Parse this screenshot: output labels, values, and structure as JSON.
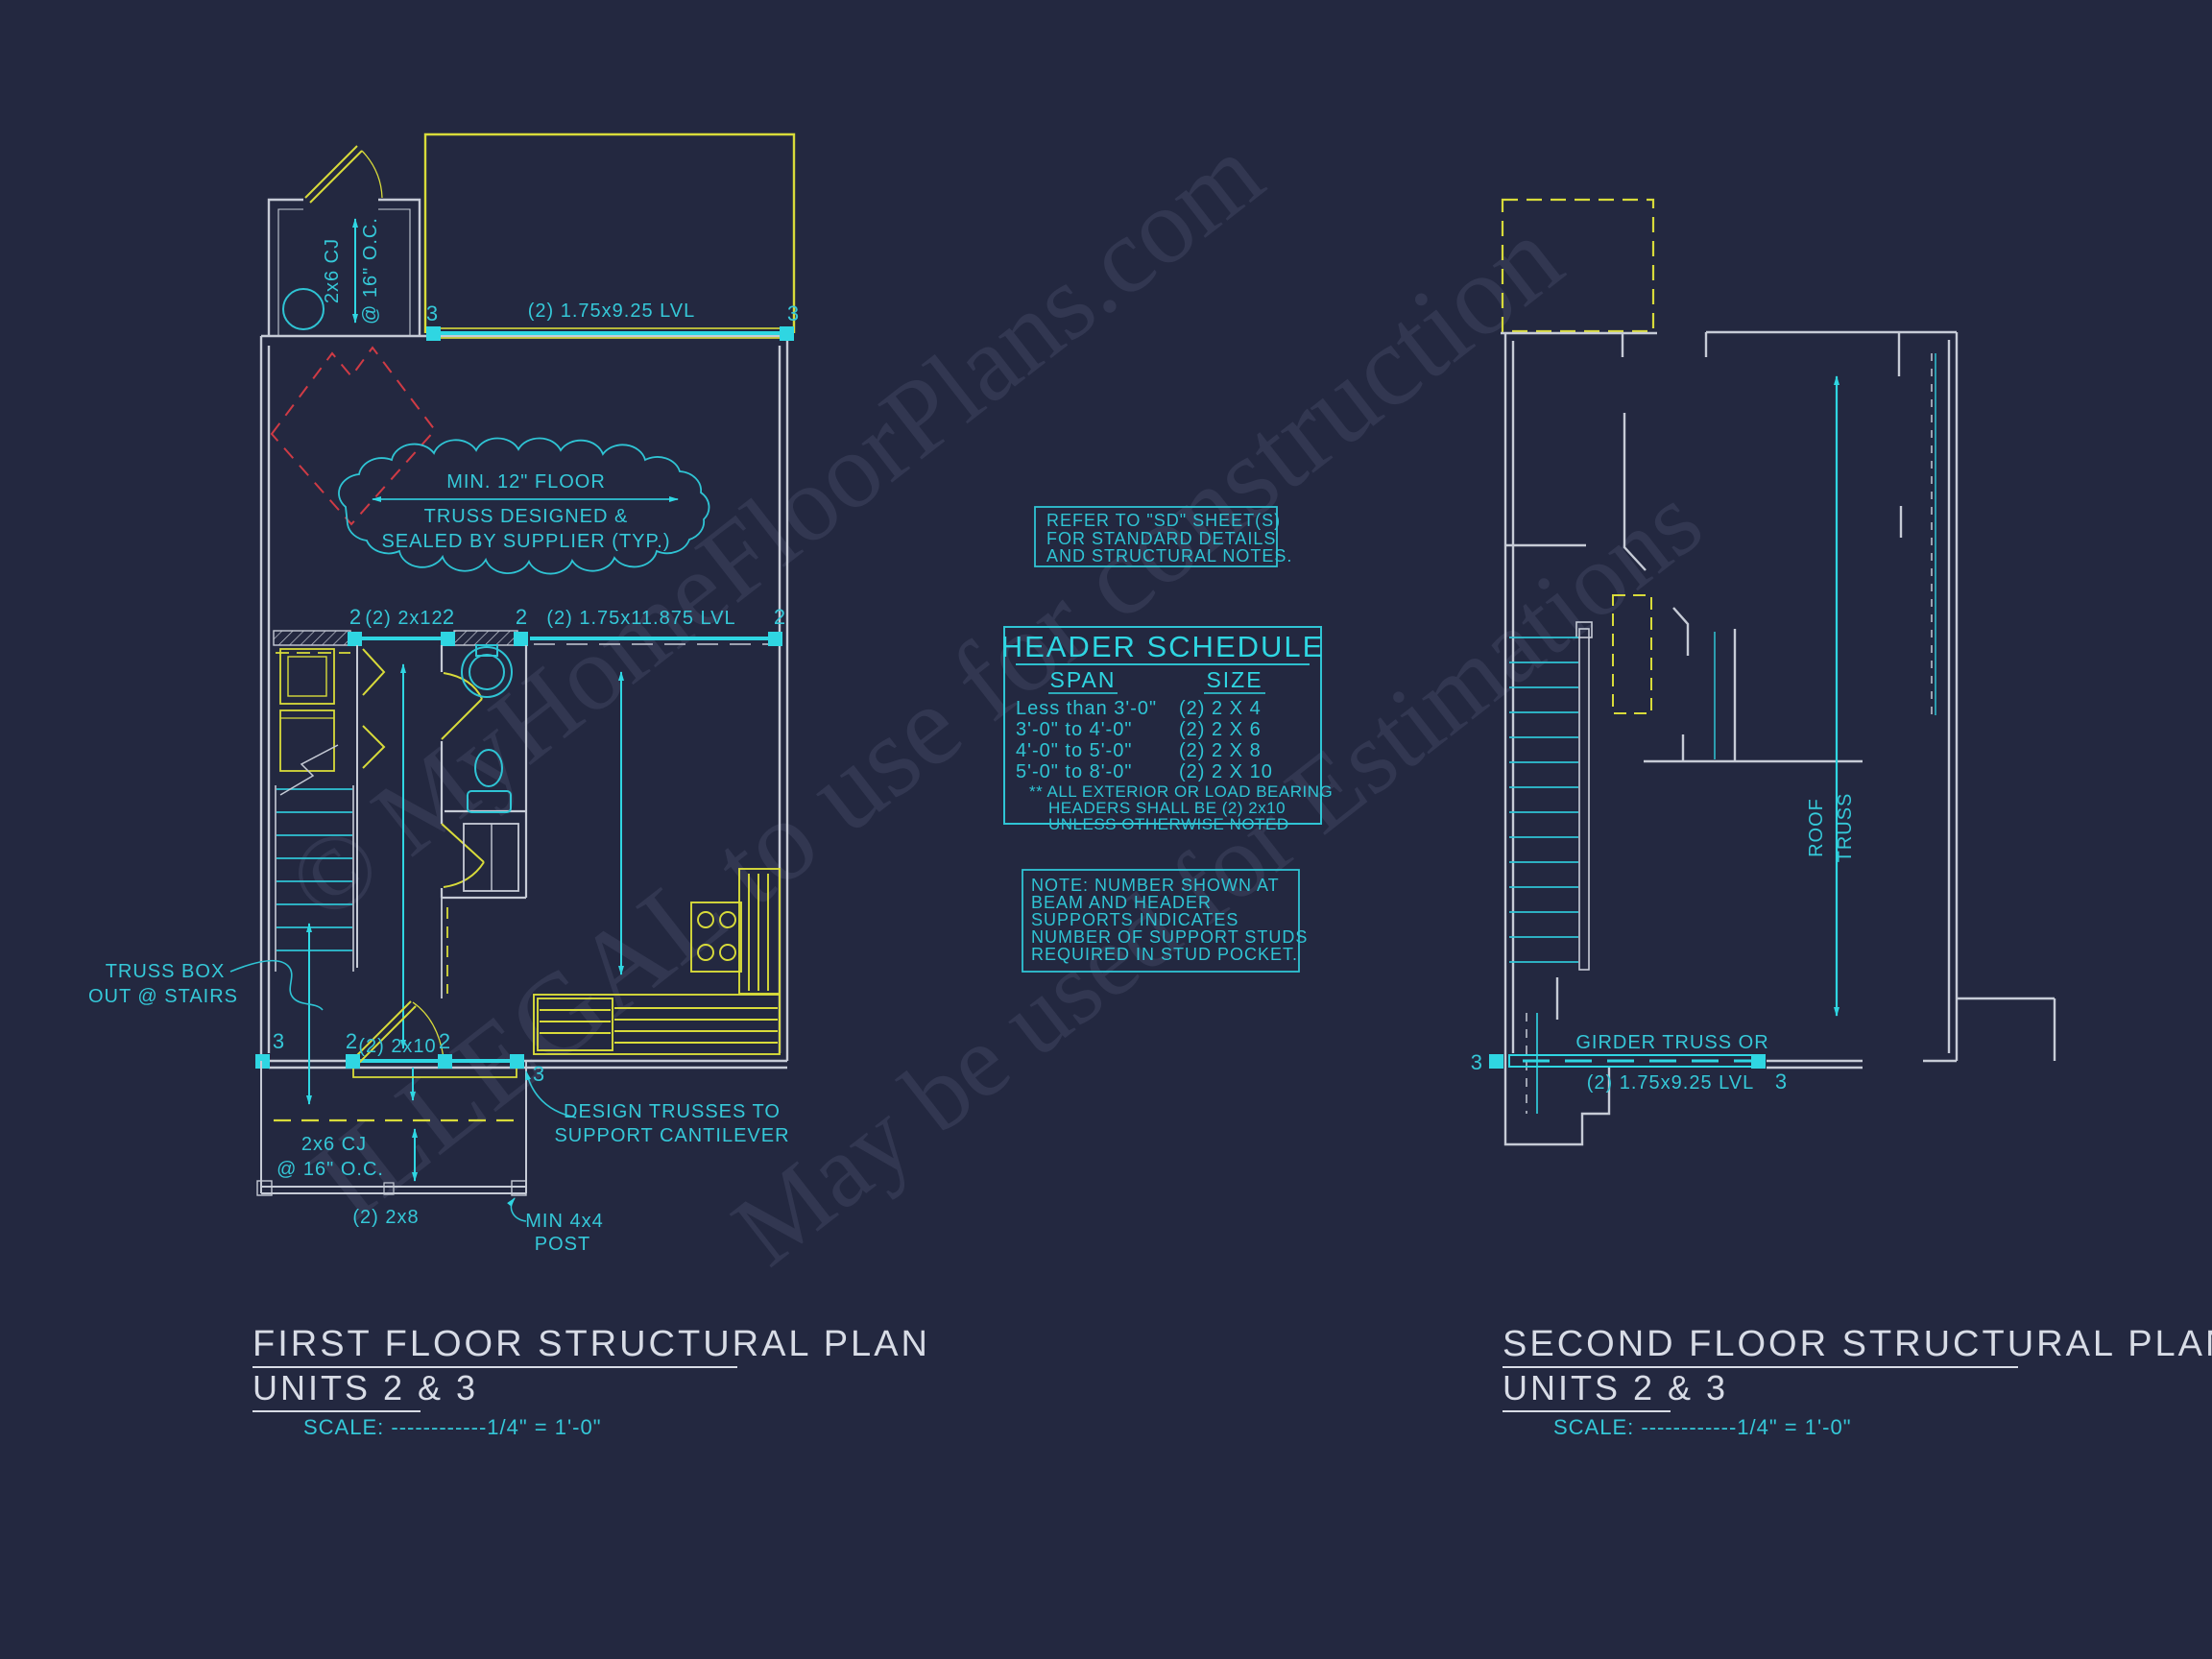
{
  "sheet": {
    "background": "#232840"
  },
  "palette": {
    "cyan_bright": "#2fd6e2",
    "cyan_text": "#35c8d8",
    "yellow": "#d8db3a",
    "wall_white": "#c6cbd6",
    "red_dashed": "#cf3b45",
    "title_text": "#d8dce6",
    "watermark": "#8c96b8"
  },
  "watermark": {
    "line1": "© MyHomeFloorPlans.com",
    "line2": "ILLEGAL to use for construction",
    "line3": "May be used for Estimations"
  },
  "numbers": {
    "two": "2",
    "three": "3"
  },
  "first_floor": {
    "entry_cj_1": "2x6 CJ",
    "entry_cj_2": "@ 16\" O.C.",
    "top_beam": "(2) 1.75x9.25 LVL",
    "cloud_1": "MIN. 12\" FLOOR",
    "cloud_2": "TRUSS DESIGNED &",
    "cloud_3": "SEALED BY SUPPLIER (TYP.)",
    "beam_2x12": "(2) 2x12",
    "beam_lvl_mid": "(2) 1.75x11.875 LVL",
    "truss_box_1": "TRUSS BOX",
    "truss_box_2": "OUT @ STAIRS",
    "beam_2x10": "(2) 2x10",
    "deck_cj_1": "2x6 CJ",
    "deck_cj_2": "@ 16\" O.C.",
    "deck_beam": "(2) 2x8",
    "post_1": "MIN 4x4",
    "post_2": "POST",
    "cantilever_1": "DESIGN TRUSSES TO",
    "cantilever_2": "SUPPORT CANTILEVER",
    "title_1": "FIRST FLOOR STRUCTURAL PLAN",
    "title_2": "UNITS 2 & 3",
    "scale": "SCALE: ------------1/4\" = 1'-0\""
  },
  "notes": {
    "sd_note": [
      "REFER TO \"SD\" SHEET(S)",
      "FOR STANDARD DETAILS",
      "AND STRUCTURAL NOTES."
    ],
    "header_schedule": {
      "title": "HEADER SCHEDULE",
      "col_span": "SPAN",
      "col_size": "SIZE",
      "rows": [
        {
          "span": "Less than 3'-0\"",
          "size": "(2) 2 X 4"
        },
        {
          "span": "3'-0\" to 4'-0\"",
          "size": "(2) 2 X 6"
        },
        {
          "span": "4'-0\" to 5'-0\"",
          "size": "(2) 2 X 8"
        },
        {
          "span": "5'-0\" to 8'-0\"",
          "size": "(2) 2 X 10"
        }
      ],
      "footnote": [
        "** ALL EXTERIOR OR LOAD BEARING",
        "HEADERS SHALL BE (2) 2x10",
        "UNLESS OTHERWISE NOTED"
      ]
    },
    "stud_note": [
      "NOTE: NUMBER SHOWN AT",
      "BEAM AND HEADER",
      "SUPPORTS INDICATES",
      "NUMBER OF SUPPORT STUDS",
      "REQUIRED IN STUD POCKET."
    ]
  },
  "second_floor": {
    "roof_truss_1": "ROOF",
    "roof_truss_2": "TRUSS",
    "girder_1": "GIRDER TRUSS OR",
    "girder_2": "(2) 1.75x9.25 LVL",
    "title_1": "SECOND FLOOR STRUCTURAL PLAN",
    "title_2": "UNITS 2 & 3",
    "scale": "SCALE: ------------1/4\" = 1'-0\""
  }
}
